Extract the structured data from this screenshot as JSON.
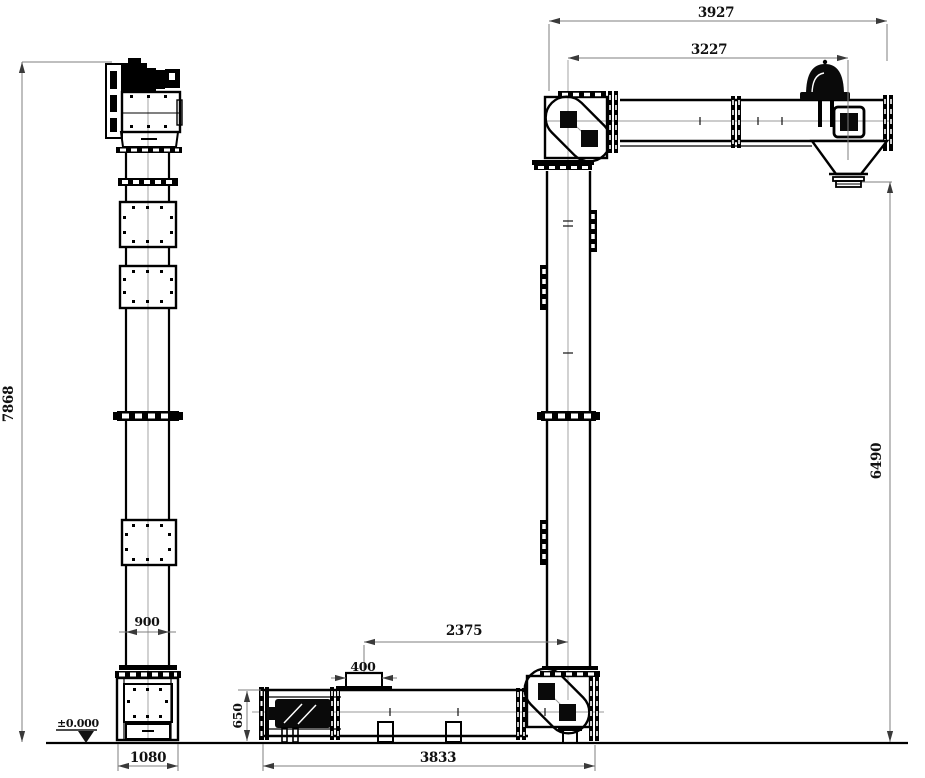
{
  "colors": {
    "background": "#ffffff",
    "drawing_line": "#000000",
    "dimension_line": "#7f7f7f",
    "centerline": "#9a9a9a",
    "text": "#111111"
  },
  "left_view": {
    "name": "bucket-elevator-elevation",
    "dims": {
      "overall_height": "7868",
      "casing_width": "900",
      "boot_width": "1080"
    },
    "level_marker": "±0.000"
  },
  "right_view": {
    "name": "z-type-conveyor-elevation",
    "dims": {
      "top_overall_length": "3927",
      "top_axis_length": "3227",
      "riser_height": "6490",
      "trough_height": "650",
      "inlet_width": "400",
      "inlet_to_riser_axis": "2375",
      "bottom_overall_length": "3833"
    }
  }
}
